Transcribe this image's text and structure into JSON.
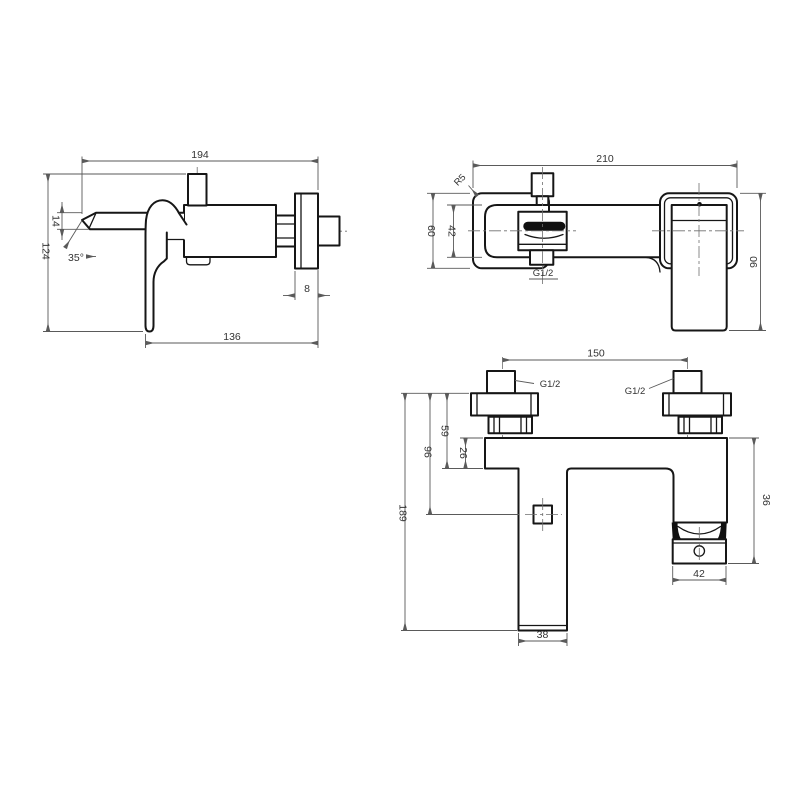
{
  "page": {
    "background_color": "#ffffff",
    "outline_color": "#161616",
    "dimension_color": "#5a5a5a"
  },
  "drawing": {
    "type": "technical-drawing",
    "subject": "wall-mounted bath shower mixer tap, three orthographic dimensioned views",
    "views": {
      "side": {
        "dims": {
          "overall_width": "194",
          "spout_height": "14",
          "overall_height": "124",
          "handle_angle": "35°",
          "body_width": "136",
          "flange_depth": "8"
        }
      },
      "front": {
        "dims": {
          "overall_width": "210",
          "corner_radius": "R5",
          "body_height": "60",
          "inner_height": "42",
          "outlet_thread": "G1/2",
          "handle_height": "90"
        }
      },
      "bottom": {
        "dims": {
          "inlet_spacing": "150",
          "thread_left": "G1/2",
          "thread_right": "G1/2",
          "flange_to_base": "59",
          "flange_to_outlet": "96",
          "base_thickness": "26",
          "overall_height": "189",
          "leg_height": "36",
          "leg_width": "42",
          "spout_width": "38"
        }
      }
    }
  }
}
